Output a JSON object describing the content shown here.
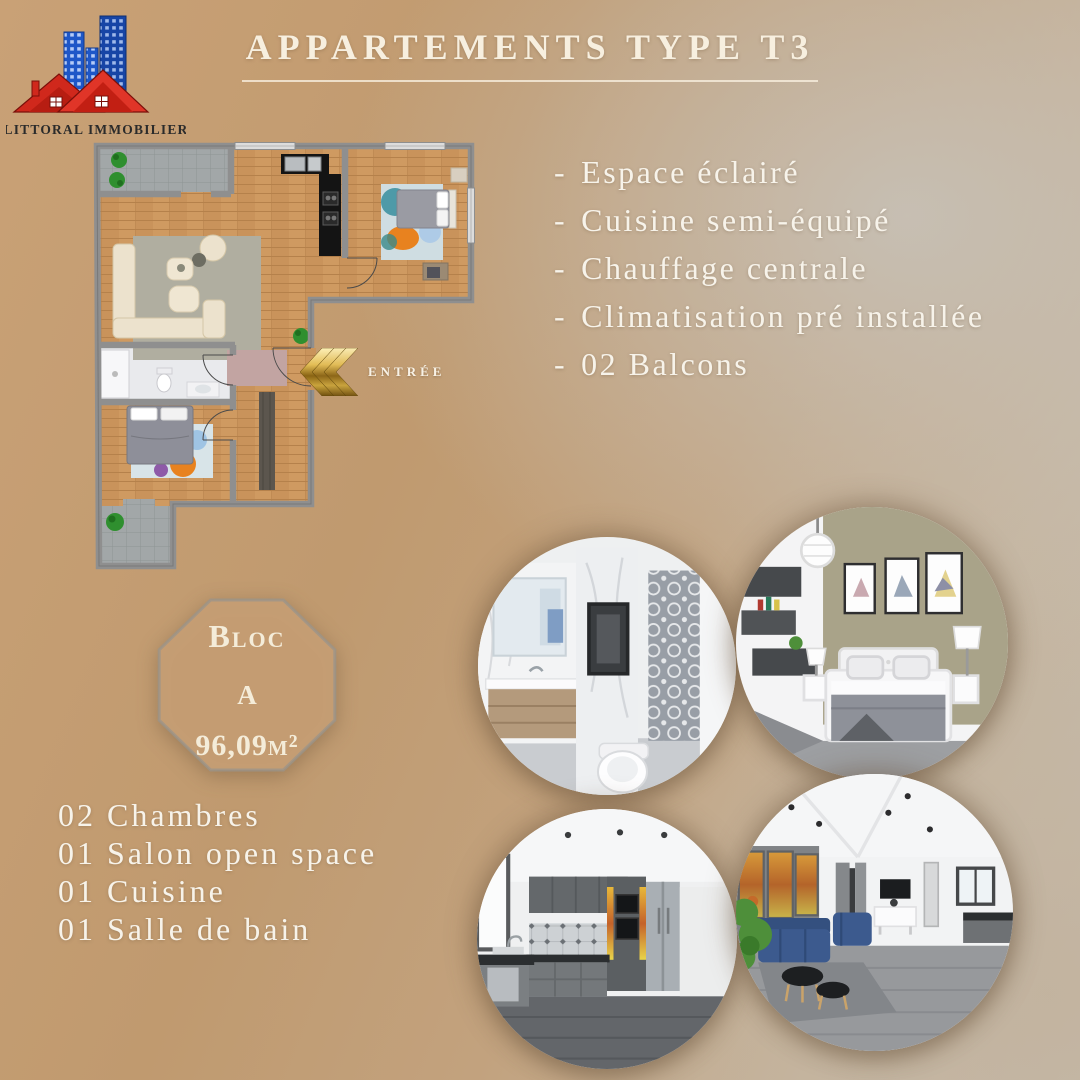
{
  "brand": {
    "name": "LITTORAL IMMOBILIER"
  },
  "title": "Appartements type T3",
  "features": {
    "bullet": "-",
    "items": [
      "Espace éclairé",
      "Cuisine semi-équipé",
      "Chauffage centrale",
      "Climatisation pré installée",
      "02 Balcons"
    ]
  },
  "floor_plan": {
    "entrance_label": "ENTRÉE"
  },
  "block": {
    "label": "Bloc",
    "letter": "A",
    "area": "96,09m²"
  },
  "composition": [
    "02 Chambres",
    "01 Salon open space",
    "01 Cuisine",
    "01 Salle de bain"
  ],
  "photos": [
    {
      "subject": "bathroom"
    },
    {
      "subject": "bedroom"
    },
    {
      "subject": "kitchen"
    },
    {
      "subject": "living-room"
    }
  ],
  "colors": {
    "background_tan": "#c09a6f",
    "background_gray": "#c3bcb0",
    "text_cream": "#f6efe0",
    "gold": "#d4af4e",
    "logo_blue": "#1d55c0",
    "logo_red": "#d2261b"
  }
}
